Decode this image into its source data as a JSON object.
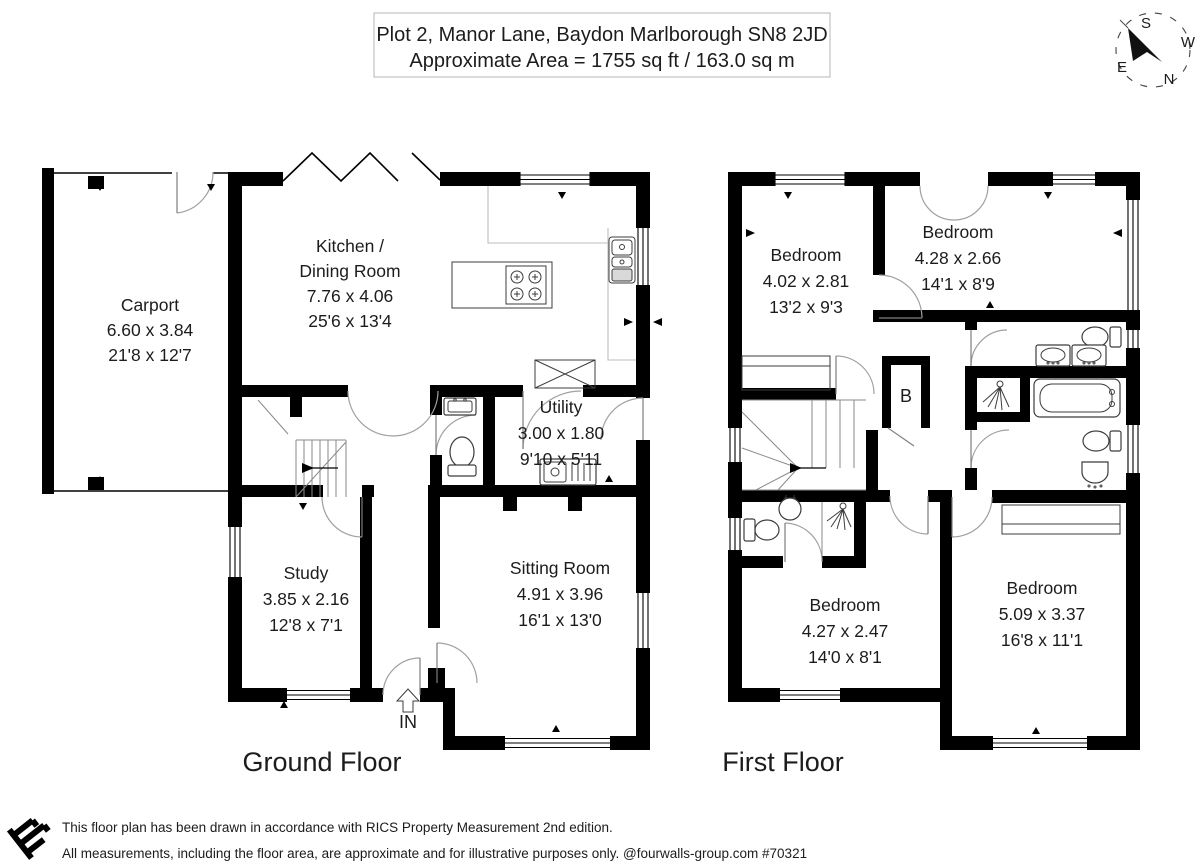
{
  "title": {
    "line1": "Plot 2, Manor Lane, Baydon Marlborough SN8 2JD",
    "line2": "Approximate Area = 1755 sq ft / 163.0 sq m"
  },
  "compass": {
    "north": "N",
    "south": "S",
    "east": "E",
    "west": "W"
  },
  "ground_floor": {
    "label": "Ground Floor",
    "entrance_label": "IN",
    "carport": {
      "name": "Carport",
      "metric": "6.60 x 3.84",
      "imperial": "21'8 x 12'7"
    },
    "kitchen_dining": {
      "name_line1": "Kitchen /",
      "name_line2": "Dining Room",
      "metric": "7.76 x 4.06",
      "imperial": "25'6 x 13'4"
    },
    "utility": {
      "name": "Utility",
      "metric": "3.00 x 1.80",
      "imperial": "9'10 x 5'11"
    },
    "study": {
      "name": "Study",
      "metric": "3.85 x 2.16",
      "imperial": "12'8 x 7'1"
    },
    "sitting_room": {
      "name": "Sitting Room",
      "metric": "4.91 x 3.96",
      "imperial": "16'1 x 13'0"
    }
  },
  "first_floor": {
    "label": "First Floor",
    "boiler_label": "B",
    "bedroom_top_left": {
      "name": "Bedroom",
      "metric": "4.02 x 2.81",
      "imperial": "13'2 x 9'3"
    },
    "bedroom_top_right": {
      "name": "Bedroom",
      "metric": "4.28 x 2.66",
      "imperial": "14'1 x 8'9"
    },
    "bedroom_bottom_left": {
      "name": "Bedroom",
      "metric": "4.27 x 2.47",
      "imperial": "14'0 x 8'1"
    },
    "bedroom_bottom_right": {
      "name": "Bedroom",
      "metric": "5.09 x 3.37",
      "imperial": "16'8 x 11'1"
    }
  },
  "footer": {
    "line1": "This floor plan has been drawn in accordance with RICS Property Measurement 2nd edition.",
    "line2": "All measurements, including the floor area, are approximate and for illustrative purposes only. @fourwalls-group.com #70321"
  },
  "colors": {
    "wall": "#000000",
    "text": "#1c1c1c",
    "door_arc": "#a0a0a0",
    "background": "#ffffff"
  }
}
